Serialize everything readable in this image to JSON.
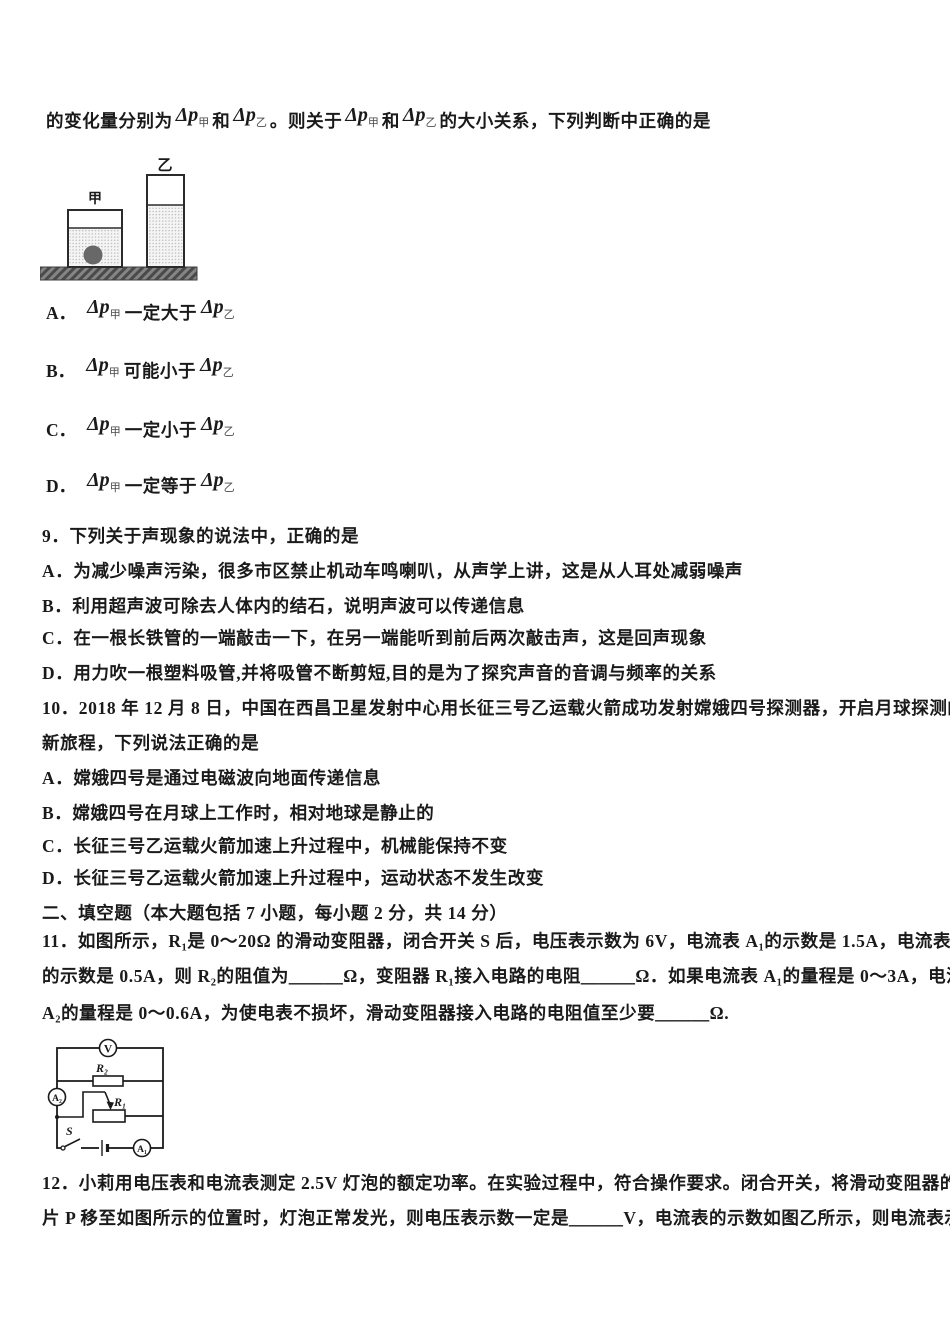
{
  "colors": {
    "text": "#1a1a1a",
    "ground_fill": "#7d7d7d",
    "ball_fill": "#686868",
    "liquid_fill": "#f4f4f4"
  },
  "q8": {
    "intro": {
      "t0": "的变化量分别为",
      "f1": {
        "sym": "Δp",
        "sub": "甲"
      },
      "t1": "和",
      "f2": {
        "sym": "Δp",
        "sub": "乙"
      },
      "t2": "。则关于",
      "f3": {
        "sym": "Δp",
        "sub": "甲"
      },
      "t3": "和",
      "f4": {
        "sym": "Δp",
        "sub": "乙"
      },
      "t4": "的大小关系，下列判断中正确的是"
    },
    "figure": {
      "label_left": "甲",
      "label_right": "乙"
    },
    "options": [
      {
        "letter": "A．",
        "left": {
          "sym": "Δp",
          "sub": "甲"
        },
        "mid": "一定大于",
        "right": {
          "sym": "Δp",
          "sub": "乙"
        }
      },
      {
        "letter": "B．",
        "left": {
          "sym": "Δp",
          "sub": "甲"
        },
        "mid": "可能小于",
        "right": {
          "sym": "Δp",
          "sub": "乙"
        }
      },
      {
        "letter": "C．",
        "left": {
          "sym": "Δp",
          "sub": "甲"
        },
        "mid": "一定小于",
        "right": {
          "sym": "Δp",
          "sub": "乙"
        }
      },
      {
        "letter": "D．",
        "left": {
          "sym": "Δp",
          "sub": "甲"
        },
        "mid": "一定等于",
        "right": {
          "sym": "Δp",
          "sub": "乙"
        }
      }
    ]
  },
  "q9": {
    "stem": "9．下列关于声现象的说法中，正确的是",
    "options": [
      "A．为减少噪声污染，很多市区禁止机动车鸣喇叭，从声学上讲，这是从人耳处减弱噪声",
      "B．利用超声波可除去人体内的结石，说明声波可以传递信息",
      "C．在一根长铁管的一端敲击一下，在另一端能听到前后两次敲击声，这是回声现象",
      "D．用力吹一根塑料吸管,并将吸管不断剪短,目的是为了探究声音的音调与频率的关系"
    ]
  },
  "q10": {
    "stem_line1": "10．2018 年 12 月 8 日，中国在西昌卫星发射中心用长征三号乙运载火箭成功发射嫦娥四号探测器，开启月球探测的",
    "stem_line2": "新旅程，下列说法正确的是",
    "options": [
      "A．嫦娥四号是通过电磁波向地面传递信息",
      "B．嫦娥四号在月球上工作时，相对地球是静止的",
      "C．长征三号乙运载火箭加速上升过程中，机械能保持不变",
      "D．长征三号乙运载火箭加速上升过程中，运动状态不发生改变"
    ]
  },
  "section2_heading": "二、填空题（本大题包括 7 小题，每小题 2 分，共 14 分）",
  "q11": {
    "line1": "11．如图所示，R₁是 0～20Ω 的滑动变阻器，闭合开关 S 后，电压表示数为 6V，电流表 A₁的示数是 1.5A，电流表 A₂",
    "line2": "的示数是 0.5A，则 R₂的阻值为＿＿＿Ω，变阻器 R₁接入电路的电阻＿＿＿Ω．如果电流表 A₁的量程是 0～3A，电流表",
    "line3": "A₂的量程是 0～0.6A，为使电表不损坏，滑动变阻器接入电路的电阻值至少要＿＿＿Ω."
  },
  "circuit": {
    "voltmeter": "V",
    "ammeter_1": "A₁",
    "ammeter_2": "A₂",
    "resistor_r2": "R₂",
    "rheostat_r1": "R₁",
    "switch": "S"
  },
  "q12": {
    "line1": "12．小莉用电压表和电流表测定 2.5V 灯泡的额定功率。在实验过程中，符合操作要求。闭合开关，将滑动变阻器的滑",
    "line2": "片 P 移至如图所示的位置时，灯泡正常发光，则电压表示数一定是＿＿＿V，电流表的示数如图乙所示，则电流表示数"
  }
}
